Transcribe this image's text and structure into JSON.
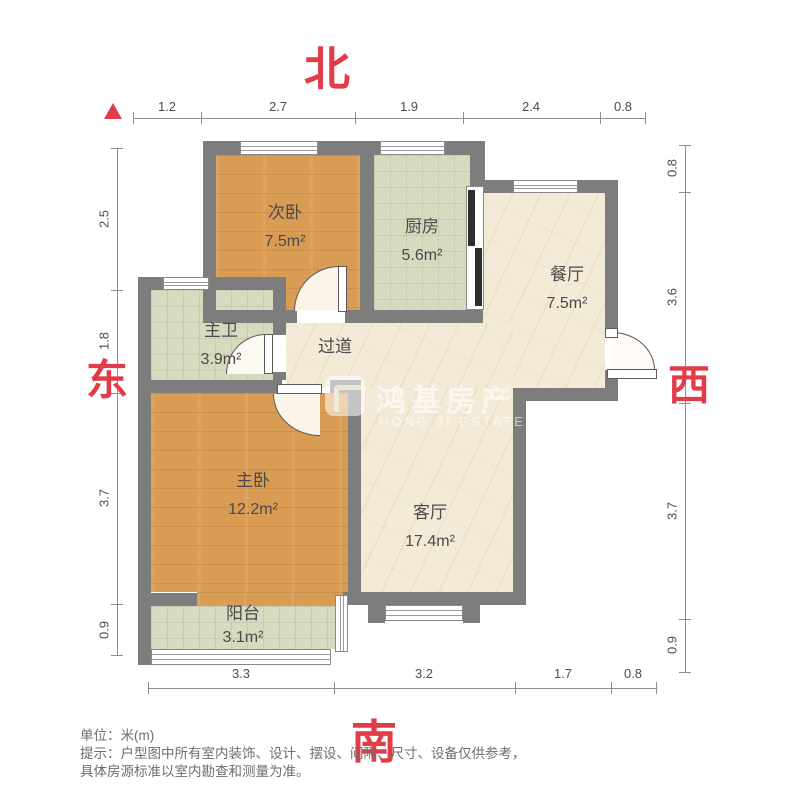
{
  "compass": {
    "north": "北",
    "south": "南",
    "east": "东",
    "west": "西"
  },
  "rooms": [
    {
      "id": "secondary-bedroom",
      "name": "次卧",
      "area": "7.5m²"
    },
    {
      "id": "kitchen",
      "name": "厨房",
      "area": "5.6m²"
    },
    {
      "id": "dining-room",
      "name": "餐厅",
      "area": "7.5m²"
    },
    {
      "id": "master-bathroom",
      "name": "主卫",
      "area": "3.9m²"
    },
    {
      "id": "hallway",
      "name": "过道",
      "area": ""
    },
    {
      "id": "master-bedroom",
      "name": "主卧",
      "area": "12.2m²"
    },
    {
      "id": "living-room",
      "name": "客厅",
      "area": "17.4m²"
    },
    {
      "id": "balcony",
      "name": "阳台",
      "area": "3.1m²"
    }
  ],
  "dimensions": {
    "top": [
      "1.2",
      "2.7",
      "1.9",
      "2.4",
      "0.8"
    ],
    "left": [
      "2.5",
      "1.8",
      "3.7",
      "0.9"
    ],
    "right": [
      "0.8",
      "3.6",
      "3.7",
      "0.9"
    ],
    "bottom": [
      "3.3",
      "3.2",
      "1.7",
      "0.8"
    ]
  },
  "watermark": {
    "cn": "鸿基房产",
    "en": "HONG JI ESTATE"
  },
  "footer": {
    "unit_line": "单位：米(m)",
    "tip_line1": "提示：户型图中所有室内装饰、设计、摆设、间隔、尺寸、设备仅供参考，",
    "tip_line2": "具体房源标准以室内勘查和测量为准。"
  },
  "colors": {
    "accent_red": "#e23c49",
    "wall_gray": "#7d7d7d",
    "wood_floor": "#d99c55",
    "tile_floor": "#d8dabf",
    "marble_floor": "#f3ebd8"
  }
}
